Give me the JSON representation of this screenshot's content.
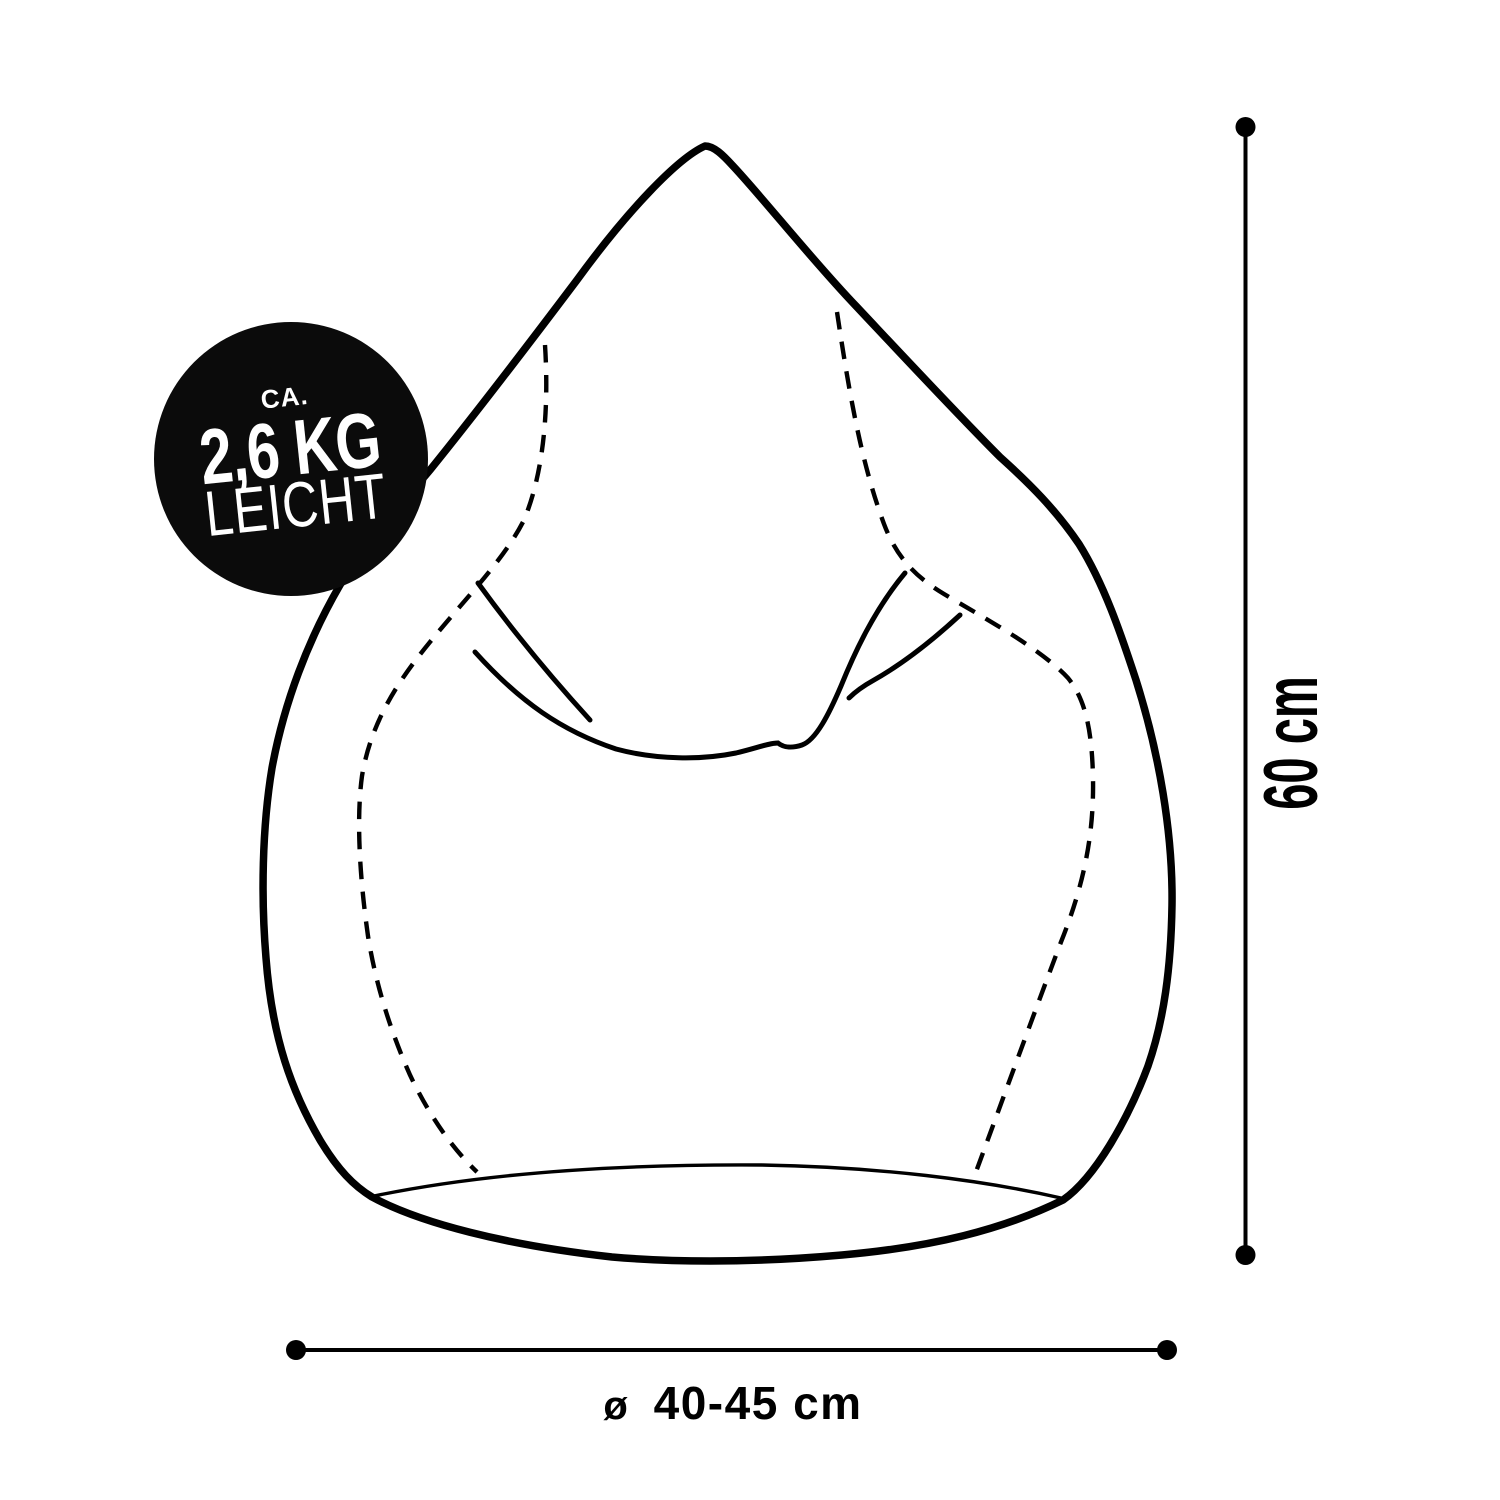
{
  "badge": {
    "prefix": "CA.",
    "weight": "2,6 KG",
    "suffix": "LEICHT"
  },
  "dimensions": {
    "height_label": "60 cm",
    "diameter_symbol": "ø",
    "diameter_label": "40-45 cm"
  },
  "colors": {
    "ink": "#000000",
    "background": "#ffffff",
    "badge_background": "#0b0b0b",
    "badge_text": "#ffffff"
  }
}
